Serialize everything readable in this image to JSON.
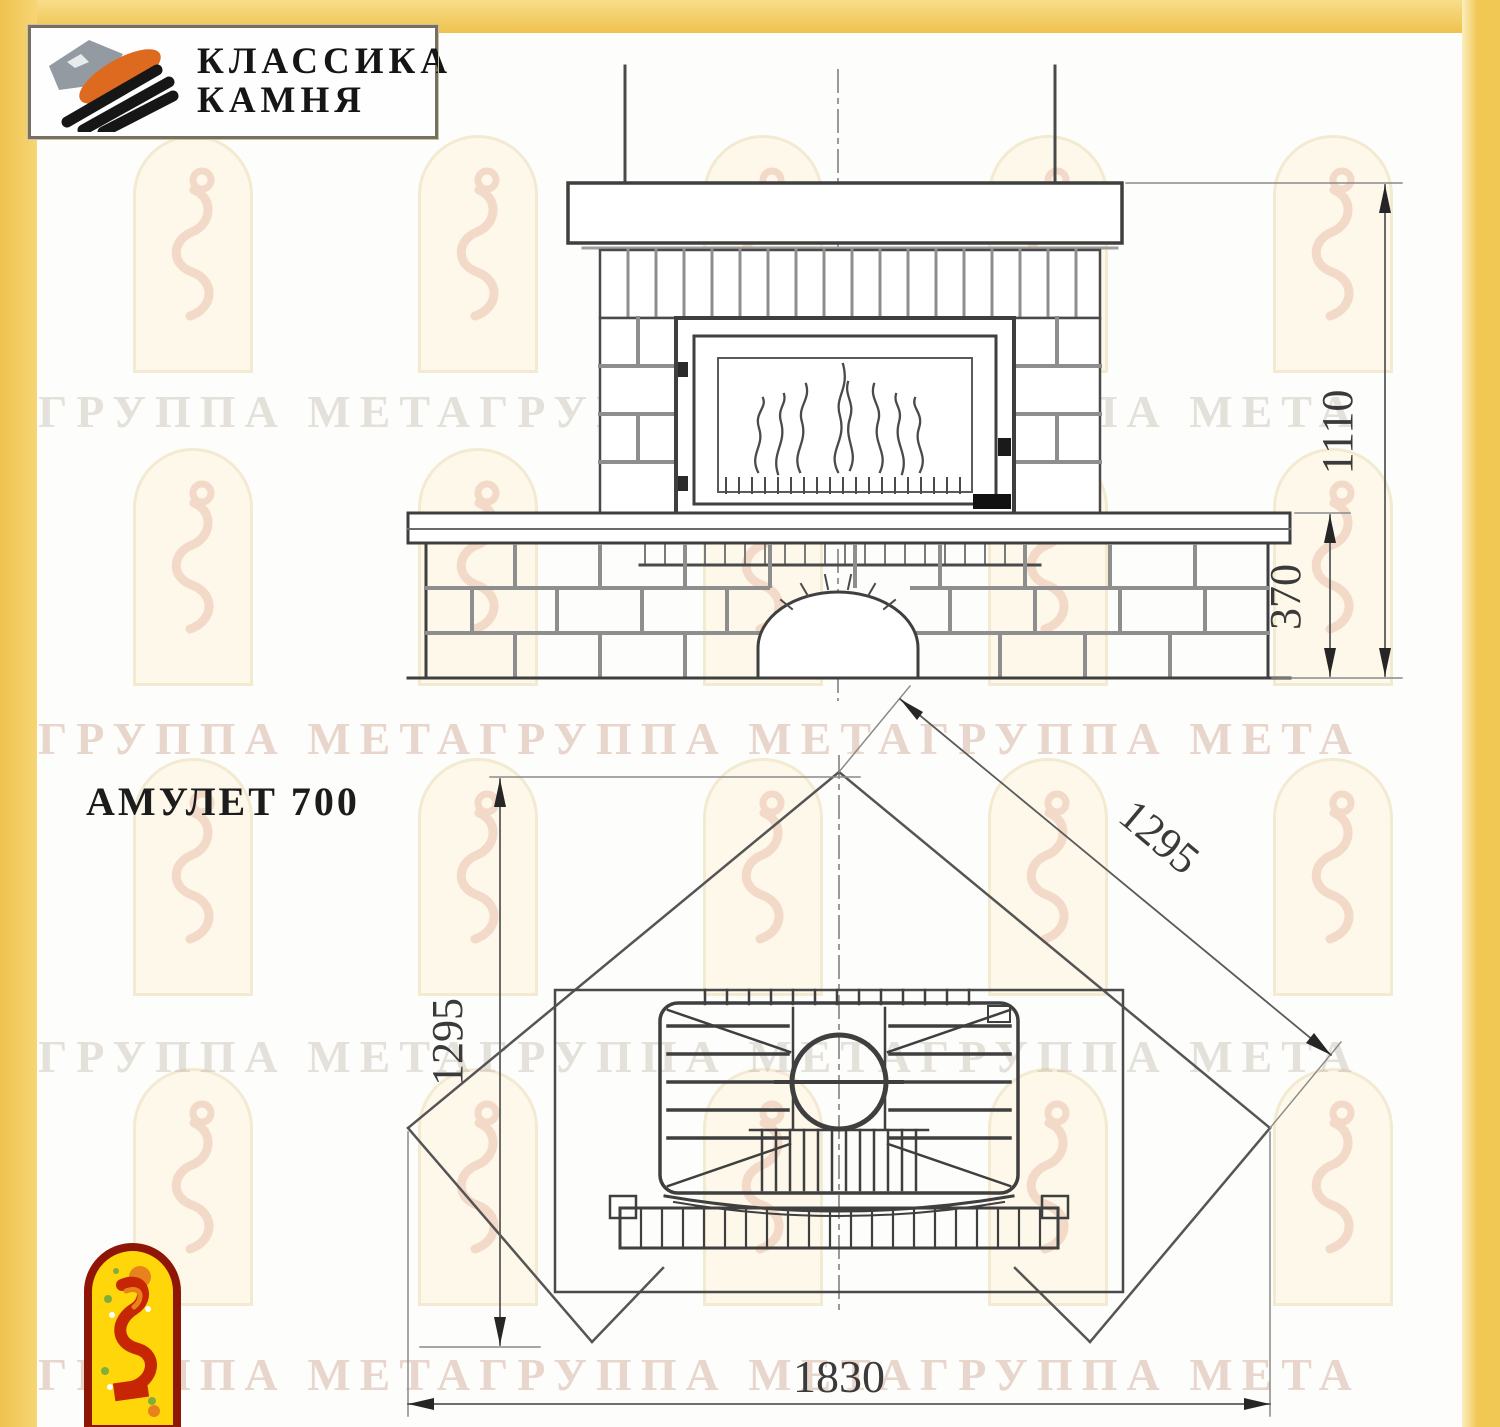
{
  "brand": {
    "line1": "КЛАССИКА",
    "line2": "КАМНЯ"
  },
  "title": "АМУЛЕТ 700",
  "watermark": {
    "text": "ГРУППА МЕТАГРУППА МЕТАГРУППА МЕТА",
    "rows": 4,
    "arch_rows": 4,
    "arch_cols": 5
  },
  "front_view": {
    "dim_total_height": "1110",
    "dim_bench_height": "370"
  },
  "plan_view": {
    "dim_side_left": "1295",
    "dim_side_right": "1295",
    "dim_front_width": "1830"
  },
  "colors": {
    "accent_yellow": "#F2C855",
    "line_dark": "#3F3F3F",
    "line_gray": "#8E8E8E",
    "logo_orange": "#DD6A1E",
    "logo_gray": "#949AA2",
    "crest_red": "#8F1507",
    "crest_yellow": "#FFD60A"
  }
}
